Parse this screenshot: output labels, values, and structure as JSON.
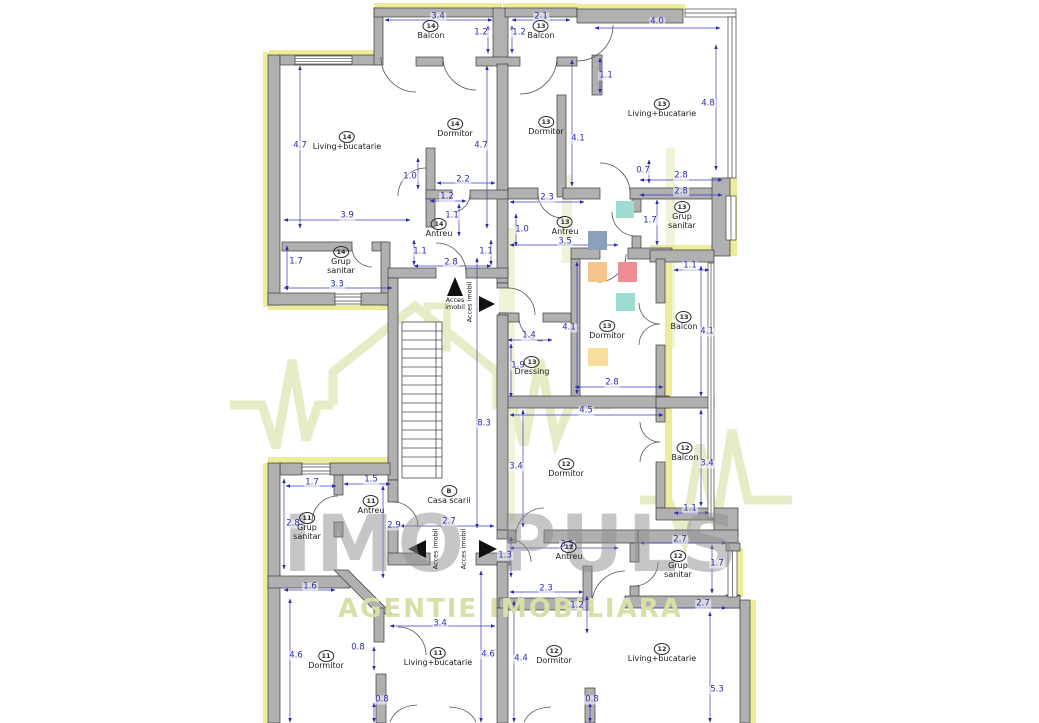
{
  "watermark": {
    "brand": "IMO PULS",
    "tagline": "AGENTIE IMOBILIARA",
    "brand_color": "#8f8f8f",
    "tagline_color": "#d9dfa6",
    "logo_color": "#e6eac3"
  },
  "plan": {
    "colors": {
      "wall": "#b0b0b0",
      "wall_edge": "#3c3c3c",
      "insulation": "#ecec9b",
      "dimension": "#2a2ab2",
      "label": "#1b1b1b"
    },
    "rooms": [
      {
        "unit": "14",
        "l1": "Balcon",
        "l2": "",
        "x": 431,
        "y": 25
      },
      {
        "unit": "13",
        "l1": "Balcon",
        "l2": "",
        "x": 541,
        "y": 25
      },
      {
        "unit": "14",
        "l1": "Living+bucatarie",
        "l2": "",
        "x": 347,
        "y": 136
      },
      {
        "unit": "14",
        "l1": "Dormitor",
        "l2": "",
        "x": 455,
        "y": 123
      },
      {
        "unit": "13",
        "l1": "Dormitor",
        "l2": "",
        "x": 546,
        "y": 121
      },
      {
        "unit": "13",
        "l1": "Living+bucatarie",
        "l2": "",
        "x": 662,
        "y": 103
      },
      {
        "unit": "14",
        "l1": "Antreu",
        "l2": "",
        "x": 439,
        "y": 223
      },
      {
        "unit": "13",
        "l1": "Antreu",
        "l2": "",
        "x": 565,
        "y": 221
      },
      {
        "unit": "13",
        "l1": "Grup",
        "l2": "sanitar",
        "x": 682,
        "y": 206
      },
      {
        "unit": "14",
        "l1": "Grup",
        "l2": "sanitar",
        "x": 341,
        "y": 251
      },
      {
        "unit": "13",
        "l1": "Dormitor",
        "l2": "",
        "x": 607,
        "y": 325
      },
      {
        "unit": "13",
        "l1": "Balcon",
        "l2": "",
        "x": 684,
        "y": 316
      },
      {
        "unit": "13",
        "l1": "Dressing",
        "l2": "",
        "x": 532,
        "y": 361
      },
      {
        "unit": "12",
        "l1": "Dormitor",
        "l2": "",
        "x": 566,
        "y": 463
      },
      {
        "unit": "12",
        "l1": "Balcon",
        "l2": "",
        "x": 685,
        "y": 447
      },
      {
        "unit": "B",
        "l1": "Casa scarii",
        "l2": "",
        "x": 449,
        "y": 490
      },
      {
        "unit": "11",
        "l1": "Antreu",
        "l2": "",
        "x": 371,
        "y": 500
      },
      {
        "unit": "11",
        "l1": "Grup",
        "l2": "sanitar",
        "x": 307,
        "y": 517
      },
      {
        "unit": "12",
        "l1": "Antreu",
        "l2": "",
        "x": 569,
        "y": 546
      },
      {
        "unit": "12",
        "l1": "Grup",
        "l2": "sanitar",
        "x": 678,
        "y": 555
      },
      {
        "unit": "11",
        "l1": "Dormitor",
        "l2": "",
        "x": 326,
        "y": 655
      },
      {
        "unit": "11",
        "l1": "Living+bucatarie",
        "l2": "",
        "x": 438,
        "y": 652
      },
      {
        "unit": "12",
        "l1": "Dormitor",
        "l2": "",
        "x": 554,
        "y": 650
      },
      {
        "unit": "12",
        "l1": "Living+bucatarie",
        "l2": "",
        "x": 662,
        "y": 648
      }
    ],
    "dimensions": [
      {
        "v": "3.4",
        "x": 438,
        "y": 17
      },
      {
        "v": "2.1",
        "x": 541,
        "y": 17
      },
      {
        "v": "1.2",
        "x": 481,
        "y": 33
      },
      {
        "v": "1.2",
        "x": 519,
        "y": 33
      },
      {
        "v": "4.0",
        "x": 657,
        "y": 22
      },
      {
        "v": "4.8",
        "x": 708,
        "y": 104
      },
      {
        "v": "4.7",
        "x": 300,
        "y": 146
      },
      {
        "v": "4.7",
        "x": 481,
        "y": 146
      },
      {
        "v": "4.1",
        "x": 578,
        "y": 139
      },
      {
        "v": "1.0",
        "x": 410,
        "y": 177
      },
      {
        "v": "2.2",
        "x": 463,
        "y": 180
      },
      {
        "v": "1.2",
        "x": 447,
        "y": 197
      },
      {
        "v": "1.1",
        "x": 452,
        "y": 216
      },
      {
        "v": "1.1",
        "x": 606,
        "y": 76
      },
      {
        "v": "0.7",
        "x": 643,
        "y": 171
      },
      {
        "v": "2.8",
        "x": 681,
        "y": 176
      },
      {
        "v": "2.8",
        "x": 681,
        "y": 192
      },
      {
        "v": "2.3",
        "x": 547,
        "y": 198
      },
      {
        "v": "1.0",
        "x": 522,
        "y": 230
      },
      {
        "v": "3.5",
        "x": 565,
        "y": 242
      },
      {
        "v": "1.7",
        "x": 650,
        "y": 221
      },
      {
        "v": "1.7",
        "x": 296,
        "y": 262
      },
      {
        "v": "3.9",
        "x": 347,
        "y": 216
      },
      {
        "v": "3.3",
        "x": 337,
        "y": 285
      },
      {
        "v": "1.1",
        "x": 420,
        "y": 252
      },
      {
        "v": "1.1",
        "x": 486,
        "y": 252
      },
      {
        "v": "2.8",
        "x": 451,
        "y": 263
      },
      {
        "v": "1.4",
        "x": 529,
        "y": 336
      },
      {
        "v": "1.9",
        "x": 518,
        "y": 366
      },
      {
        "v": "4.1",
        "x": 569,
        "y": 328
      },
      {
        "v": "2.8",
        "x": 612,
        "y": 383
      },
      {
        "v": "4.1",
        "x": 707,
        "y": 332
      },
      {
        "v": "1.1",
        "x": 690,
        "y": 266
      },
      {
        "v": "8.3",
        "x": 484,
        "y": 424
      },
      {
        "v": "4.5",
        "x": 586,
        "y": 411
      },
      {
        "v": "3.4",
        "x": 516,
        "y": 467
      },
      {
        "v": "3.4",
        "x": 707,
        "y": 464
      },
      {
        "v": "1.1",
        "x": 690,
        "y": 509
      },
      {
        "v": "2.7",
        "x": 449,
        "y": 522
      },
      {
        "v": "1.7",
        "x": 312,
        "y": 483
      },
      {
        "v": "1.5",
        "x": 371,
        "y": 480
      },
      {
        "v": "2.8",
        "x": 293,
        "y": 524
      },
      {
        "v": "2.9",
        "x": 394,
        "y": 526
      },
      {
        "v": "1.6",
        "x": 310,
        "y": 587
      },
      {
        "v": "1.3",
        "x": 505,
        "y": 556
      },
      {
        "v": "3.5",
        "x": 567,
        "y": 545
      },
      {
        "v": "2.7",
        "x": 680,
        "y": 540
      },
      {
        "v": "1.7",
        "x": 717,
        "y": 564
      },
      {
        "v": "2.7",
        "x": 703,
        "y": 604
      },
      {
        "v": "2.3",
        "x": 546,
        "y": 589
      },
      {
        "v": "1.2",
        "x": 577,
        "y": 606
      },
      {
        "v": "4.4",
        "x": 521,
        "y": 659
      },
      {
        "v": "4.6",
        "x": 296,
        "y": 656
      },
      {
        "v": "4.6",
        "x": 488,
        "y": 655
      },
      {
        "v": "3.4",
        "x": 440,
        "y": 624
      },
      {
        "v": "0.8",
        "x": 358,
        "y": 648
      },
      {
        "v": "0.8",
        "x": 382,
        "y": 700
      },
      {
        "v": "0.8",
        "x": 592,
        "y": 700
      },
      {
        "v": "5.3",
        "x": 717,
        "y": 690
      }
    ],
    "access": [
      {
        "t": "Acces imobil",
        "x": 455,
        "y": 304,
        "rot": 0
      },
      {
        "t": "Acces imobil",
        "x": 470,
        "y": 302,
        "rot": 90
      },
      {
        "t": "Acces imobil",
        "x": 436,
        "y": 549,
        "rot": 90
      },
      {
        "t": "Acces imobil",
        "x": 464,
        "y": 549,
        "rot": 90
      }
    ],
    "furniture": [
      {
        "c": "#9edcd2",
        "x": 616,
        "y": 201,
        "w": 18,
        "h": 17
      },
      {
        "c": "#8ba1bb",
        "x": 588,
        "y": 231,
        "w": 19,
        "h": 19
      },
      {
        "c": "#f6c58d",
        "x": 588,
        "y": 262,
        "w": 19,
        "h": 20
      },
      {
        "c": "#ef8d95",
        "x": 618,
        "y": 262,
        "w": 19,
        "h": 20
      },
      {
        "c": "#9edcd2",
        "x": 616,
        "y": 293,
        "w": 19,
        "h": 18
      },
      {
        "c": "#f8dc9b",
        "x": 588,
        "y": 348,
        "w": 20,
        "h": 18
      }
    ]
  }
}
